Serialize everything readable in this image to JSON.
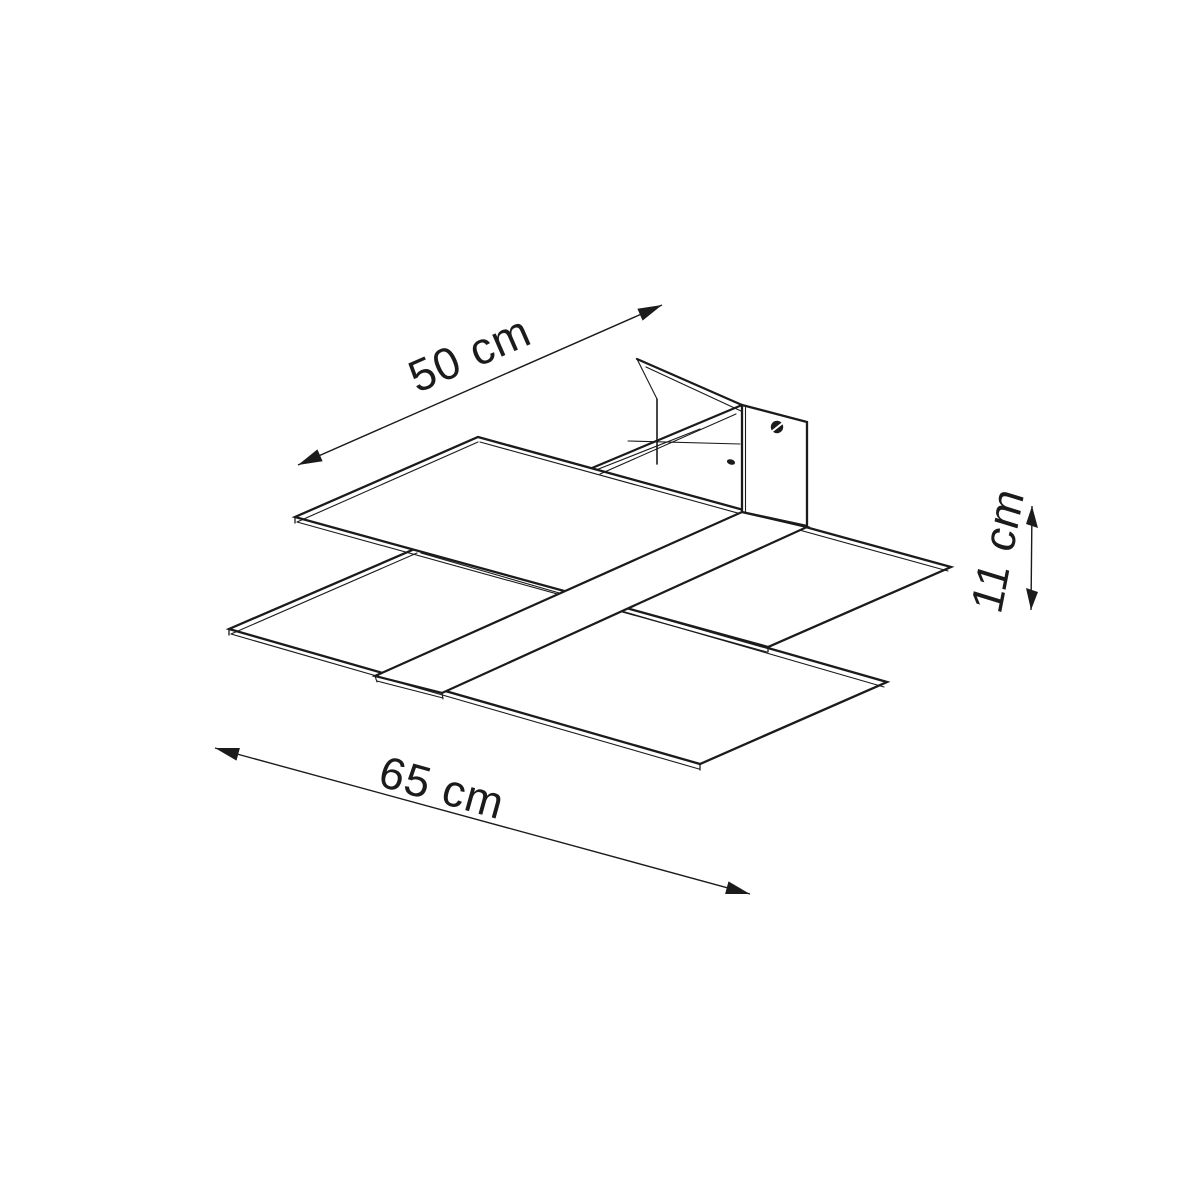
{
  "drawing": {
    "kind": "isometric dimension line drawing of a two-panel ceiling lamp",
    "labels": {
      "depth": "50 cm",
      "width": "65 cm",
      "height": "11 cm"
    },
    "colors": {
      "line": "#1b1b1b",
      "background": "#ffffff"
    },
    "icons": {
      "screw_head": "screw-head-icon",
      "screw_hole": "screw-hole-icon"
    }
  }
}
